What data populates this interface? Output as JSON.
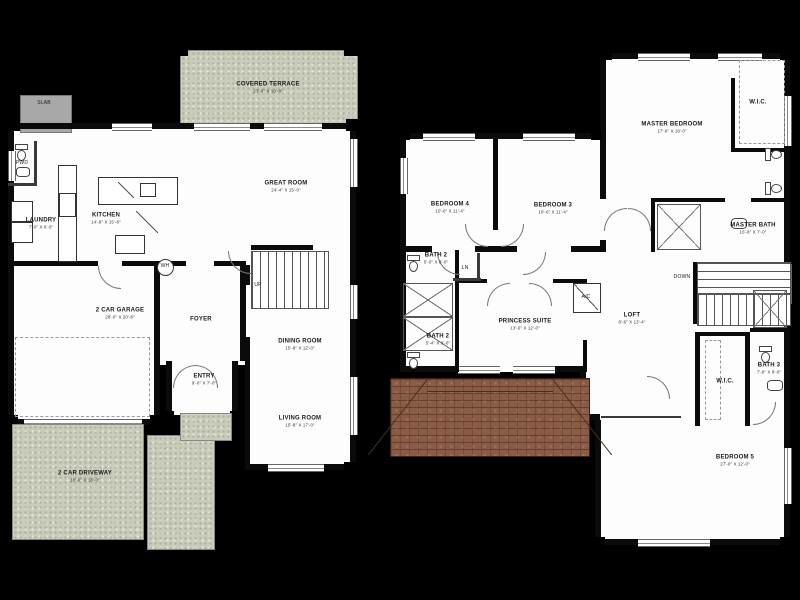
{
  "document": {
    "type": "two-story-floor-plan"
  },
  "colors": {
    "background": "#000000",
    "floor": "#fdfdfd",
    "walls": "#0b0b0b",
    "terrace_green": "#c9ccba",
    "roof_brown": "#8a5c46",
    "slab_grey": "#a8a8a8"
  },
  "floor1": {
    "terrace": {
      "label": "COVERED TERRACE",
      "dims": "23'-0\" X 10'-8\""
    },
    "great_room": {
      "label": "GREAT ROOM",
      "dims": "24'-4\" X 15'-0\""
    },
    "kitchen": {
      "label": "KITCHEN",
      "dims": "14'-8\" X 15'-8\""
    },
    "laundry": {
      "label": "LAUNDRY",
      "dims": "7'-0\" X 6'-0\""
    },
    "pwd": {
      "label": "PWD"
    },
    "slab": {
      "label": "SLAB"
    },
    "garage": {
      "label": "2 CAR GARAGE",
      "dims": "28'-0\" X 20'-8\""
    },
    "foyer": {
      "label": "FOYER"
    },
    "entry": {
      "label": "ENTRY",
      "dims": "9'-0\" X 7'-0\""
    },
    "dining": {
      "label": "DINING ROOM",
      "dims": "15'-8\" X 12'-0\""
    },
    "living": {
      "label": "LIVING ROOM",
      "dims": "15'-8\" X 17'-0\""
    },
    "driveway": {
      "label": "2 CAR DRIVEWAY",
      "dims": "18'-0\" X 18'-0\""
    },
    "wh": {
      "label": "WH"
    },
    "up": {
      "label": "UP"
    }
  },
  "floor2": {
    "master_bedroom": {
      "label": "MASTER BEDROOM",
      "dims": "17'-6\" X 18'-0\""
    },
    "master_wic": {
      "label": "W.I.C."
    },
    "master_bath": {
      "label": "MASTER BATH",
      "dims": "16'-8\" X 7'-0\""
    },
    "bedroom4": {
      "label": "BEDROOM 4",
      "dims": "10'-6\" X 11'-4\""
    },
    "bedroom3": {
      "label": "BEDROOM 3",
      "dims": "10'-6\" X 11'-4\""
    },
    "bath2_upper": {
      "label": "BATH 2",
      "dims": "5'-0\" X 8'-0\""
    },
    "linen": {
      "label": "LN"
    },
    "bath2_lower": {
      "label": "BATH 2",
      "dims": "5'-4\" X 9'-6\""
    },
    "princess_suite": {
      "label": "PRINCESS SUITE",
      "dims": "13'-0\" X 12'-0\""
    },
    "ac": {
      "label": "A/C"
    },
    "loft": {
      "label": "LOFT",
      "dims": "8'-6\" X 13'-4\""
    },
    "down": {
      "label": "DOWN"
    },
    "wic2": {
      "label": "W.I.C."
    },
    "bath3": {
      "label": "BATH 3",
      "dims": "7'-6\" X 8'-6\""
    },
    "bedroom5": {
      "label": "BEDROOM 5",
      "dims": "27'-0\" X 12'-0\""
    }
  }
}
